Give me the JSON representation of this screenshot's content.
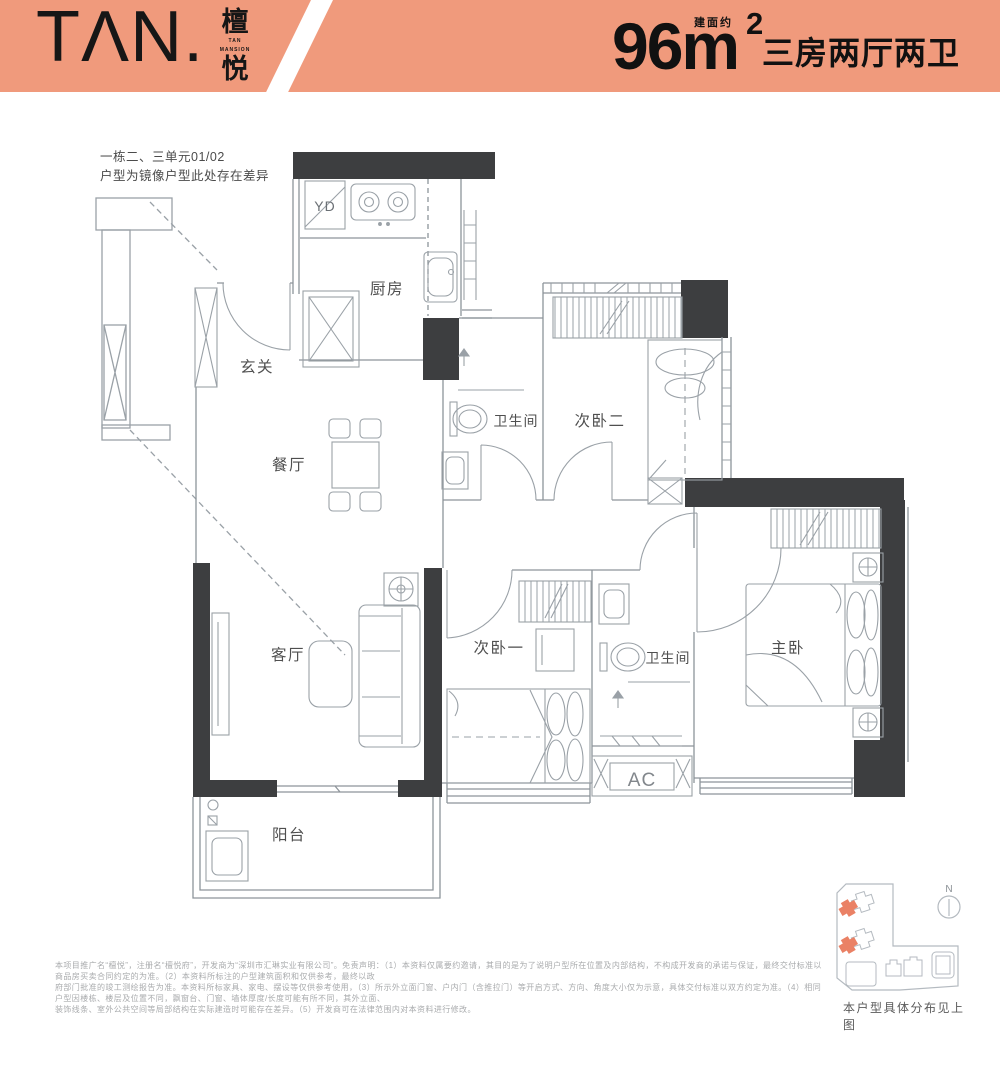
{
  "header": {
    "logo": {
      "latin": "TΛN.",
      "cn_top": "檀",
      "cn_bottom": "悦",
      "sub_line1": "TAN",
      "sub_line2": "MANSION"
    },
    "area": {
      "prefix": "建面约",
      "big": "96m",
      "sup": "2"
    },
    "layout_desc": "三房两厅两卫",
    "band_color": "#f09a7c"
  },
  "note": {
    "line1": "一栋二、三单元01/02",
    "line2": "户型为镜像户型此处存在差异"
  },
  "plan": {
    "rooms": {
      "kitchen": "厨房",
      "hall": "玄关",
      "dining": "餐厅",
      "bath1": "卫生间",
      "bed2": "次卧二",
      "living": "客厅",
      "bed1": "次卧一",
      "bath2": "卫生间",
      "master": "主卧",
      "balcony": "阳台"
    },
    "marks": {
      "duct": "YD",
      "ac": "AC"
    },
    "wall_color": "#3d3e40",
    "line_color": "#8d949a"
  },
  "sitemap": {
    "north": "N",
    "caption": "本户型具体分布见上图",
    "highlight_color": "#ea8165"
  },
  "disclaimer": {
    "line1": "本项目推广名“檀悦”，注册名“檀悦府”，开发商为“深圳市汇琳实业有限公司”。免责声明：（1）本资料仅属要约邀请，其目的是为了说明户型所在位置及内部结构，不构成开发商的承诺与保证，最终交付标准以商品房买卖合同约定的为准。（2）本资料所标注的户型建筑面积和仅供参考，最终以政",
    "line2": "府部门批准的竣工测绘报告为准。本资料所标家具、家电、摆设等仅供参考使用，（3）所示外立面门窗、户内门（含推拉门）等开启方式、方向、角度大小仅为示意，具体交付标准以双方约定为准。（4）相同户型因楼栋、楼层及位置不同，飘窗台、门窗、墙体厚度/长度可能有所不同，其外立面、",
    "line3": "装饰线条、室外公共空间等局部结构在实际建造时可能存在差异。（5）开发商可在法律范围内对本资料进行修改。"
  }
}
